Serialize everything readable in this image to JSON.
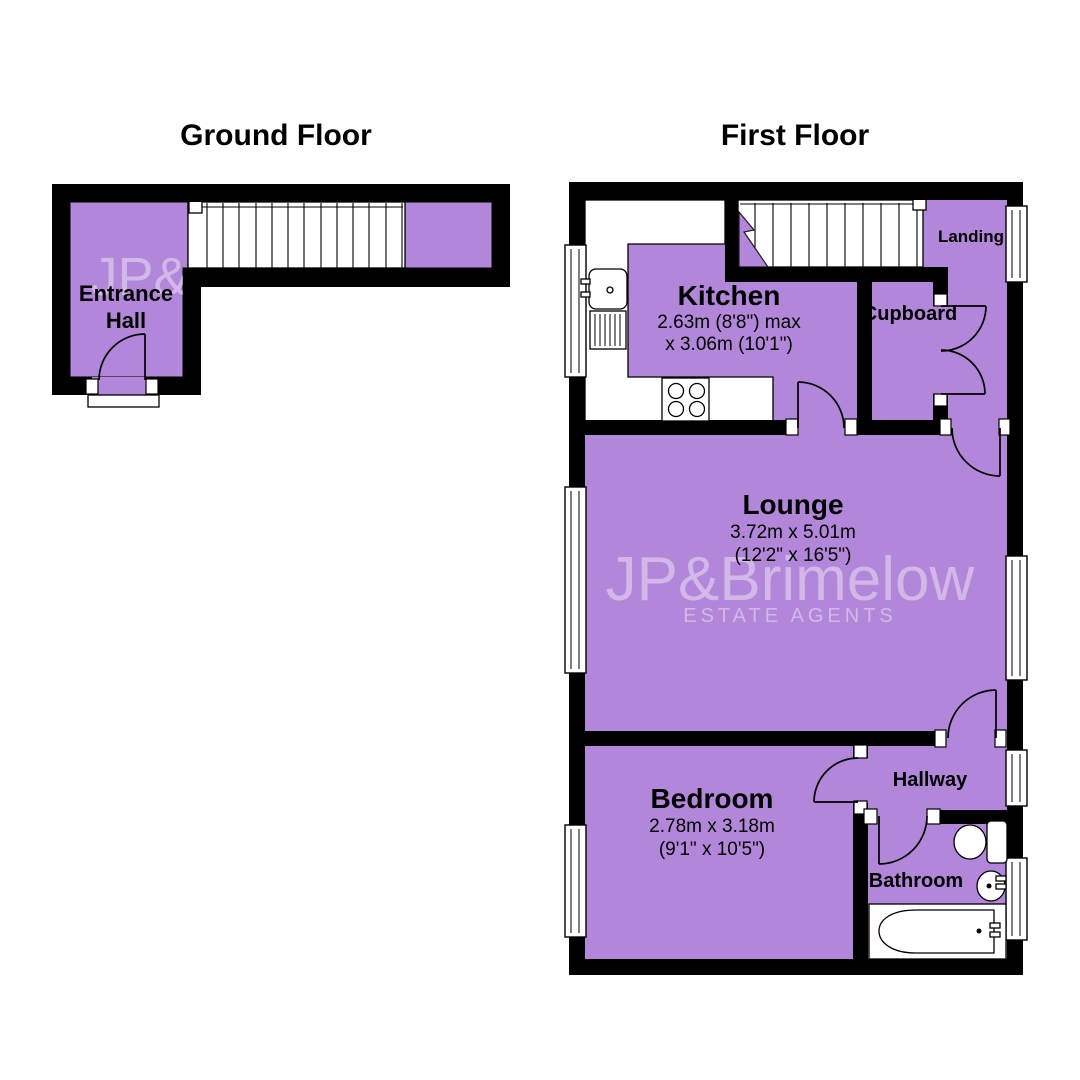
{
  "ground_floor": {
    "title": "Ground Floor",
    "watermark": "JP&",
    "rooms": {
      "entrance_hall": {
        "line1": "Entrance",
        "line2": "Hall"
      }
    }
  },
  "first_floor": {
    "title": "First Floor",
    "watermark": {
      "line1": "JP&Brimelow",
      "line2": "ESTATE AGENTS"
    },
    "rooms": {
      "kitchen": {
        "name": "Kitchen",
        "dim_metric": "2.63m (8'8\") max",
        "dim_imperial": "x 3.06m (10'1\")"
      },
      "cupboard": {
        "name": "Cupboard"
      },
      "landing": {
        "name": "Landing"
      },
      "lounge": {
        "name": "Lounge",
        "dim_metric": "3.72m x 5.01m",
        "dim_imperial": "(12'2\" x 16'5\")"
      },
      "bedroom": {
        "name": "Bedroom",
        "dim_metric": "2.78m x 3.18m",
        "dim_imperial": "(9'1\" x 10'5\")"
      },
      "hallway": {
        "name": "Hallway"
      },
      "bathroom": {
        "name": "Bathroom"
      }
    }
  },
  "colors": {
    "room_fill": "#b286d8",
    "wall": "#000000",
    "watermark": "rgba(255,255,255,0.42)",
    "background": "#ffffff"
  }
}
